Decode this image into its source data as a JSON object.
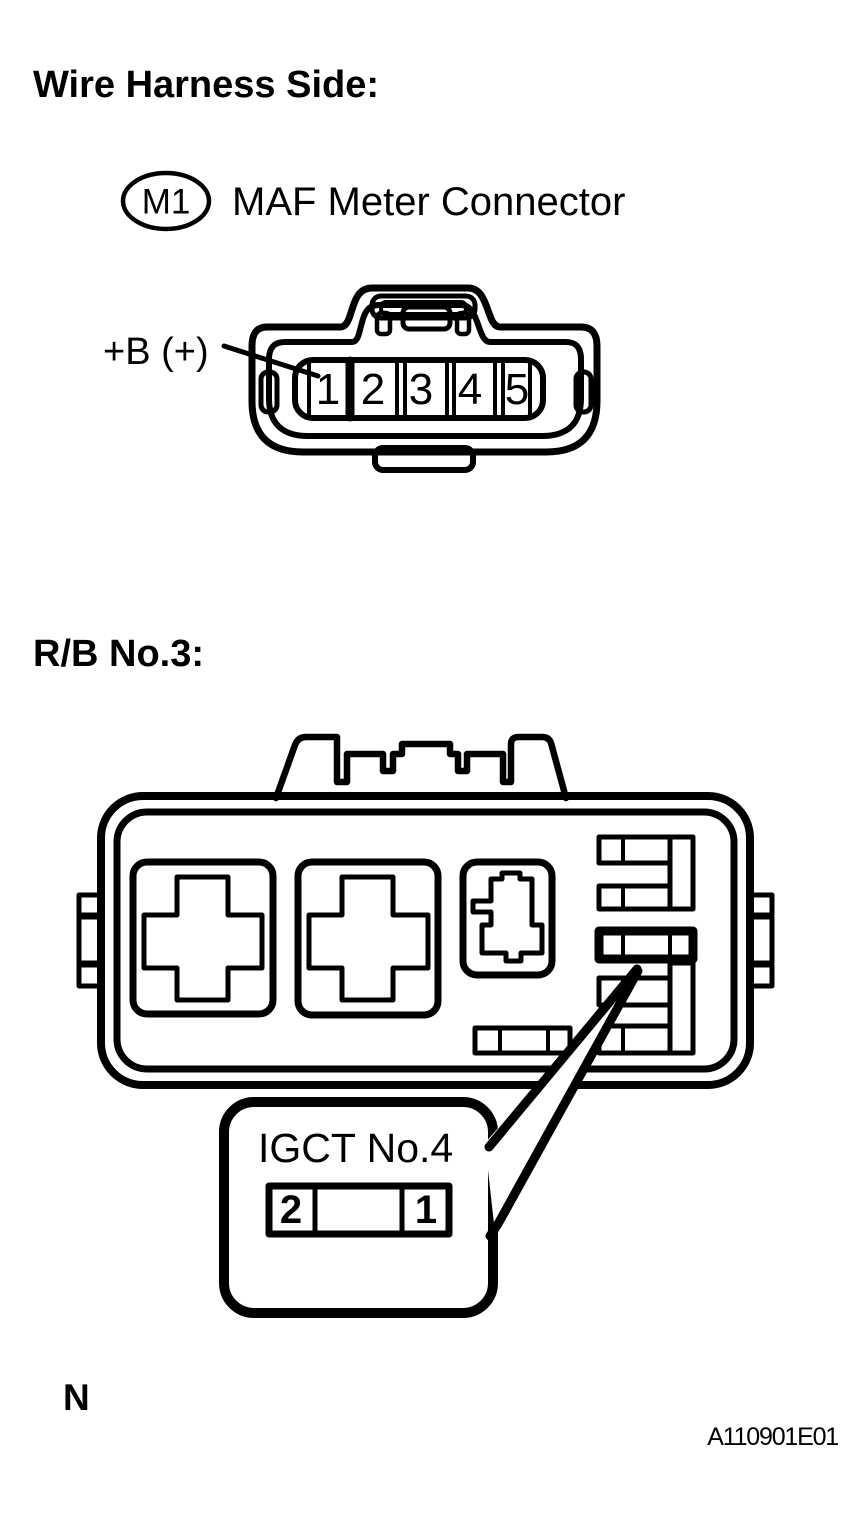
{
  "page": {
    "section1_heading": "Wire Harness Side:",
    "section2_heading": "R/B No.3:",
    "footnote": "N",
    "figure_code": "A110901E01"
  },
  "maf": {
    "id_label": "M1",
    "name": "MAF Meter Connector",
    "terminal_label": "+B (+)",
    "pins": [
      "1",
      "2",
      "3",
      "4",
      "5"
    ]
  },
  "rb": {
    "callout": {
      "fuse_name": "IGCT No.4",
      "pin_left": "2",
      "pin_right": "1"
    }
  },
  "colors": {
    "line": "#000000",
    "background": "#ffffff"
  }
}
